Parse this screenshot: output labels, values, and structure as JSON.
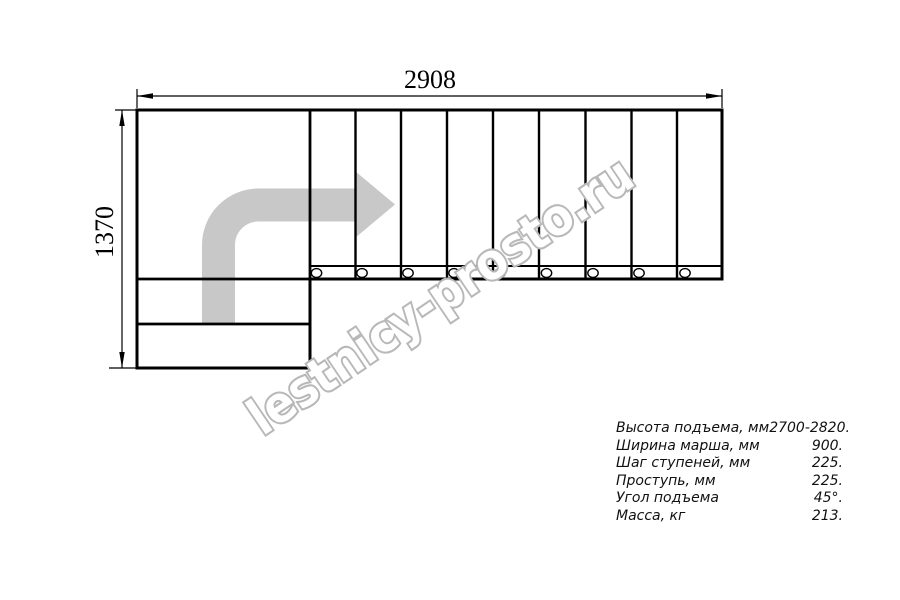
{
  "drawing": {
    "title_hint": "staircase-plan-top-view",
    "top_dimension_label": "2908",
    "left_dimension_label": "1370",
    "tread_count": 9,
    "mount_circle_count": 9,
    "colors": {
      "line": "#000000",
      "arrow_fill": "#c8c8c8",
      "watermark_stroke": "#b8b8b8",
      "background": "#ffffff"
    }
  },
  "watermark": {
    "text": "lestnicy-prosto.ru"
  },
  "specs": {
    "rows": [
      {
        "label": "Высота подъема, мм",
        "value": "2700-2820."
      },
      {
        "label": "Ширина марша, мм",
        "value": "900."
      },
      {
        "label": "Шаг ступеней, мм",
        "value": "225."
      },
      {
        "label": "Проступь, мм",
        "value": "225."
      },
      {
        "label": "Угол подъема",
        "value": "45°."
      },
      {
        "label": "Масса, кг",
        "value": "213."
      }
    ]
  }
}
